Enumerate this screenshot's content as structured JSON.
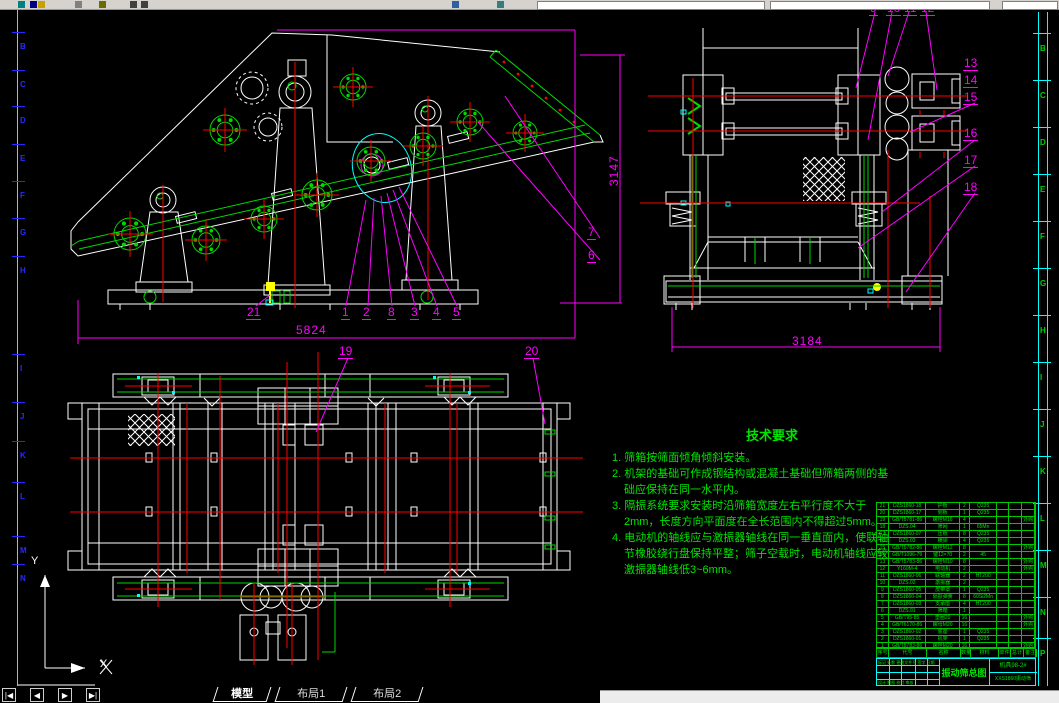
{
  "colors": {
    "bg": "#000000",
    "line": "#ffffff",
    "green": "#00d900",
    "red": "#ff0000",
    "magenta": "#ff00ff",
    "cyan": "#00ffff",
    "yellow": "#ffff00",
    "zone_left": "#2a2aff",
    "zone_right": "#00d000",
    "toolbar_bg": "#d6d3ce"
  },
  "tabs": {
    "nav": [
      "|◀",
      "◀",
      "▶",
      "▶|"
    ],
    "items": [
      {
        "label": "模型",
        "active": true
      },
      {
        "label": "布局1",
        "active": false
      },
      {
        "label": "布局2",
        "active": false
      }
    ]
  },
  "ucs": {
    "x_label": "X",
    "y_label": "Y"
  },
  "drawing": {
    "dimensions": {
      "front_width": "5824",
      "front_height": "3147",
      "end_width": "3184"
    },
    "callouts": [
      {
        "n": "21",
        "x": 246,
        "y": 306
      },
      {
        "n": "1",
        "x": 341,
        "y": 306
      },
      {
        "n": "2",
        "x": 362,
        "y": 306
      },
      {
        "n": "8",
        "x": 387,
        "y": 306
      },
      {
        "n": "3",
        "x": 410,
        "y": 306
      },
      {
        "n": "4",
        "x": 432,
        "y": 306
      },
      {
        "n": "5",
        "x": 452,
        "y": 306
      },
      {
        "n": "19",
        "x": 338,
        "y": 345
      },
      {
        "n": "20",
        "x": 524,
        "y": 345
      },
      {
        "n": "7",
        "x": 587,
        "y": 226
      },
      {
        "n": "6",
        "x": 587,
        "y": 249
      },
      {
        "n": "9",
        "x": 869,
        "y": 2
      },
      {
        "n": "10",
        "x": 886,
        "y": 2
      },
      {
        "n": "11",
        "x": 903,
        "y": 2
      },
      {
        "n": "12",
        "x": 920,
        "y": 2
      },
      {
        "n": "13",
        "x": 963,
        "y": 57
      },
      {
        "n": "14",
        "x": 963,
        "y": 74
      },
      {
        "n": "15",
        "x": 963,
        "y": 91
      },
      {
        "n": "16",
        "x": 963,
        "y": 127
      },
      {
        "n": "17",
        "x": 963,
        "y": 154
      },
      {
        "n": "18",
        "x": 963,
        "y": 181
      }
    ],
    "zone_letters_left": [
      {
        "ch": "B",
        "y": 43
      },
      {
        "ch": "C",
        "y": 81
      },
      {
        "ch": "D",
        "y": 117
      },
      {
        "ch": "E",
        "y": 155
      },
      {
        "ch": "F",
        "y": 192
      },
      {
        "ch": "G",
        "y": 229
      },
      {
        "ch": "H",
        "y": 267
      },
      {
        "ch": "I",
        "y": 365
      },
      {
        "ch": "J",
        "y": 413
      },
      {
        "ch": "K",
        "y": 452
      },
      {
        "ch": "L",
        "y": 493
      },
      {
        "ch": "M",
        "y": 547
      },
      {
        "ch": "N",
        "y": 575
      }
    ],
    "zone_letters_right": [
      {
        "ch": "B",
        "y": 45
      },
      {
        "ch": "C",
        "y": 92
      },
      {
        "ch": "D",
        "y": 139
      },
      {
        "ch": "E",
        "y": 186
      },
      {
        "ch": "F",
        "y": 233
      },
      {
        "ch": "G",
        "y": 280
      },
      {
        "ch": "H",
        "y": 327
      },
      {
        "ch": "I",
        "y": 374
      },
      {
        "ch": "J",
        "y": 421
      },
      {
        "ch": "K",
        "y": 468
      },
      {
        "ch": "L",
        "y": 515
      },
      {
        "ch": "M",
        "y": 562
      },
      {
        "ch": "N",
        "y": 609
      },
      {
        "ch": "P",
        "y": 650
      }
    ],
    "tech_requirements": {
      "title": "技术要求",
      "items": [
        "1. 筛箱按筛面倾角倾斜安装。",
        "2. 机架的基础可作成钢结构或混凝土基础但筛箱两侧的基础应保持在同一水平内。",
        "3. 隔振系统要求安装时沿筛箱宽度左右平行度不大于2mm，长度方向平面度在全长范围内不得超过5mm。",
        "4. 电动机的轴线应与激振器轴线在同一垂直面内，使联轴节橡胶绕行盘保持平整；筛子空载时，电动机轴线应较激振器轴线低3~6mm。"
      ]
    },
    "parts_table": {
      "header": [
        "序号",
        "代号",
        "名称",
        "数量",
        "材料",
        "单件",
        "总计",
        "备注"
      ],
      "rows": [
        [
          "21",
          "DZS1860-18",
          "护板",
          "2",
          "Q235",
          "",
          "",
          ""
        ],
        [
          "20",
          "DZS1860-17",
          "侧板",
          "1",
          "Q235",
          "",
          "",
          ""
        ],
        [
          "19",
          "GB/T5781-86",
          "螺栓M16",
          "4",
          "",
          "",
          "",
          "外购"
        ],
        [
          "18",
          "DZS.04",
          "筛网",
          "1",
          "65Mn",
          "",
          "",
          ""
        ],
        [
          "17",
          "DZS1860-07",
          "压板",
          "8",
          "Q235",
          "",
          "",
          ""
        ],
        [
          "16",
          "DZS.03",
          "横梁",
          "4",
          "Q235",
          "",
          "",
          ""
        ],
        [
          "15",
          "GB/T5782-86",
          "螺栓M12",
          "8",
          "",
          "",
          "",
          "外购"
        ],
        [
          "14",
          "GB/T1096-79",
          "键12×70",
          "2",
          "45",
          "",
          "",
          ""
        ],
        [
          "13",
          "GB/T5783-86",
          "螺栓M10",
          "8",
          "",
          "",
          "",
          "外购"
        ],
        [
          "12",
          "Y160M-4",
          "电动机",
          "2",
          "",
          "",
          "",
          "外购"
        ],
        [
          "11",
          "DZS1860-06",
          "联轴器",
          "2",
          "HT200",
          "",
          "",
          ""
        ],
        [
          "10",
          "DZS.02",
          "激振器",
          "2",
          "",
          "",
          "",
          ""
        ],
        [
          "9",
          "DZS1860-05",
          "皮带罩",
          "1",
          "Q235",
          "",
          "",
          ""
        ],
        [
          "8",
          "DZS1860-04",
          "隔振弹簧",
          "8",
          "60Si2Mn",
          "",
          "",
          ""
        ],
        [
          "7",
          "DZS1860-03",
          "支承座",
          "4",
          "HT200",
          "",
          "",
          ""
        ],
        [
          "6",
          "DZS.01",
          "筛箱",
          "1",
          "",
          "",
          "",
          ""
        ],
        [
          "5",
          "GB/T95-85",
          "垫圈20",
          "16",
          "",
          "",
          "",
          "外购"
        ],
        [
          "4",
          "GB/T6170-86",
          "螺母M20",
          "16",
          "",
          "",
          "",
          "外购"
        ],
        [
          "3",
          "DZS1860-02",
          "底座",
          "1",
          "Q235",
          "",
          "",
          ""
        ],
        [
          "2",
          "DZS1860-01",
          "机架",
          "1",
          "Q235",
          "",
          "",
          ""
        ],
        [
          "1",
          "GB/T5783-86",
          "螺栓M20",
          "16",
          "",
          "",
          "",
          "外购"
        ]
      ]
    },
    "title_block": {
      "title": "振动筛总图",
      "code": "机具98-2#",
      "model": "XXS1860振动筛",
      "rev_labels": "标记 处数 更改文件号 签字 日期",
      "sign_labels": "设计 制图 校对 审核"
    }
  }
}
